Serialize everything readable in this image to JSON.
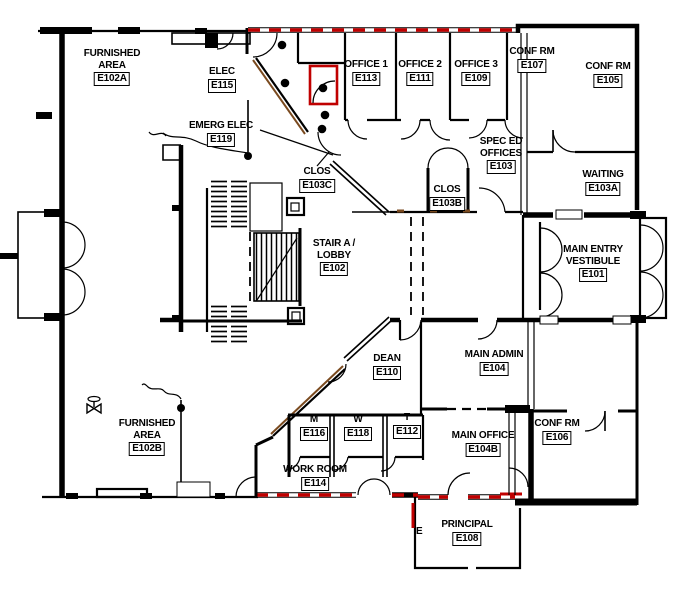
{
  "drawing": {
    "title": "Building E first floor plan",
    "annotations": {
      "stray_label": "E"
    },
    "colors": {
      "wall": "#000000",
      "fire_wall": "#c00000",
      "accent_shadow": "#7a4a1f",
      "background": "#ffffff"
    }
  },
  "rooms": [
    {
      "id": "furnished-area-a",
      "name": "FURNISHED\nAREA",
      "number": "E102A"
    },
    {
      "id": "elec",
      "name": "ELEC",
      "number": "E115"
    },
    {
      "id": "emerg-elec",
      "name": "EMERG ELEC",
      "number": "E119"
    },
    {
      "id": "office-1",
      "name": "OFFICE 1",
      "number": "E113"
    },
    {
      "id": "office-2",
      "name": "OFFICE 2",
      "number": "E111"
    },
    {
      "id": "office-3",
      "name": "OFFICE 3",
      "number": "E109"
    },
    {
      "id": "conf-rm-e107",
      "name": "CONF RM",
      "number": "E107"
    },
    {
      "id": "conf-rm-e105",
      "name": "CONF RM",
      "number": "E105"
    },
    {
      "id": "spec-ed-offices",
      "name": "SPEC ED\nOFFICES",
      "number": "E103"
    },
    {
      "id": "waiting",
      "name": "WAITING",
      "number": "E103A"
    },
    {
      "id": "clos-e103c",
      "name": "CLOS",
      "number": "E103C"
    },
    {
      "id": "clos-e103b",
      "name": "CLOS",
      "number": "E103B"
    },
    {
      "id": "stair-a-lobby",
      "name": "STAIR A /\nLOBBY",
      "number": "E102"
    },
    {
      "id": "main-entry-vestibule",
      "name": "MAIN ENTRY\nVESTIBULE",
      "number": "E101"
    },
    {
      "id": "dean",
      "name": "DEAN",
      "number": "E110"
    },
    {
      "id": "main-admin",
      "name": "MAIN ADMIN",
      "number": "E104"
    },
    {
      "id": "furnished-area-b",
      "name": "FURNISHED\nAREA",
      "number": "E102B"
    },
    {
      "id": "toilet-m",
      "name": "M",
      "number": "E116"
    },
    {
      "id": "toilet-w",
      "name": "W",
      "number": "E118"
    },
    {
      "id": "toilet-t",
      "name": "T",
      "number": "E112"
    },
    {
      "id": "main-office",
      "name": "MAIN OFFICE",
      "number": "E104B"
    },
    {
      "id": "conf-rm-e106",
      "name": "CONF RM",
      "number": "E106"
    },
    {
      "id": "work-room",
      "name": "WORK ROOM",
      "number": "E114"
    },
    {
      "id": "principal",
      "name": "PRINCIPAL",
      "number": "E108"
    }
  ]
}
